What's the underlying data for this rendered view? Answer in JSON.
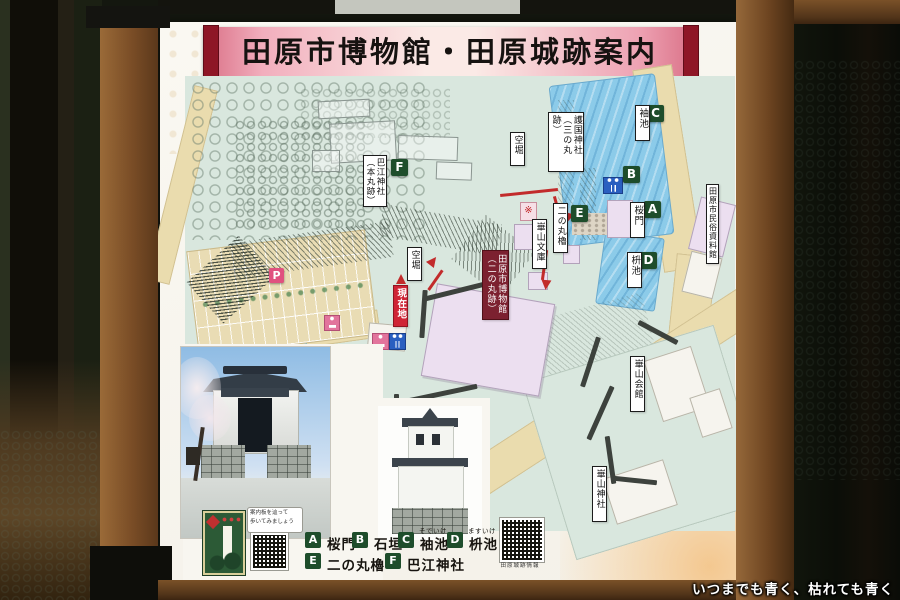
{
  "sign": {
    "title": "田原市博物館・田原城跡案内",
    "map": {
      "labels": {
        "gokoku": "護国神社\n（三の丸跡）",
        "sodeike": "袖池",
        "karabori1": "空堀",
        "karabori2": "空堀",
        "haie": "巴江神社\n（本丸跡）",
        "ninomaru_yagura": "二の丸櫓",
        "sakuramon": "桜門",
        "masuike": "枡池",
        "kazan_bunko": "崋山文庫",
        "museum": "田原市博物館\n（二の丸跡）",
        "genzaichi": "現在地",
        "minzoku": "田原市民俗資料館",
        "kazan_kaikan": "崋山会館",
        "kazan_jinja": "崋山神社"
      },
      "badges": {
        "a": "A",
        "b": "B",
        "c": "C",
        "d": "D",
        "e": "E",
        "f": "F",
        "parking": "P"
      }
    },
    "legend": {
      "items": [
        {
          "key": "A",
          "label": "桜門",
          "furigana": ""
        },
        {
          "key": "B",
          "label": "石垣",
          "furigana": ""
        },
        {
          "key": "C",
          "label": "袖池",
          "furigana": "そでいけ"
        },
        {
          "key": "D",
          "label": "枡池",
          "furigana": "ますいけ"
        },
        {
          "key": "E",
          "label": "二の丸櫓",
          "furigana": ""
        },
        {
          "key": "F",
          "label": "巴江神社",
          "furigana": ""
        }
      ],
      "qr_caption": "田原城跡情報"
    },
    "inset": {
      "note_line1": "案内板を辿って",
      "note_line2": "歩いてみましょう"
    }
  },
  "photo": {
    "watermark": "いつまでも青く、枯れても青く"
  },
  "colors": {
    "banner_pink": "#f3b9c6",
    "banner_end_red": "#8e1626",
    "badge_green": "#1e4d2b",
    "current_location_red": "#cf2435",
    "museum_label_maroon": "#7c2130",
    "map_ground_mint": "#d9e7de",
    "road_tan": "#eadcae",
    "water_blue": "#8ccbe9"
  }
}
